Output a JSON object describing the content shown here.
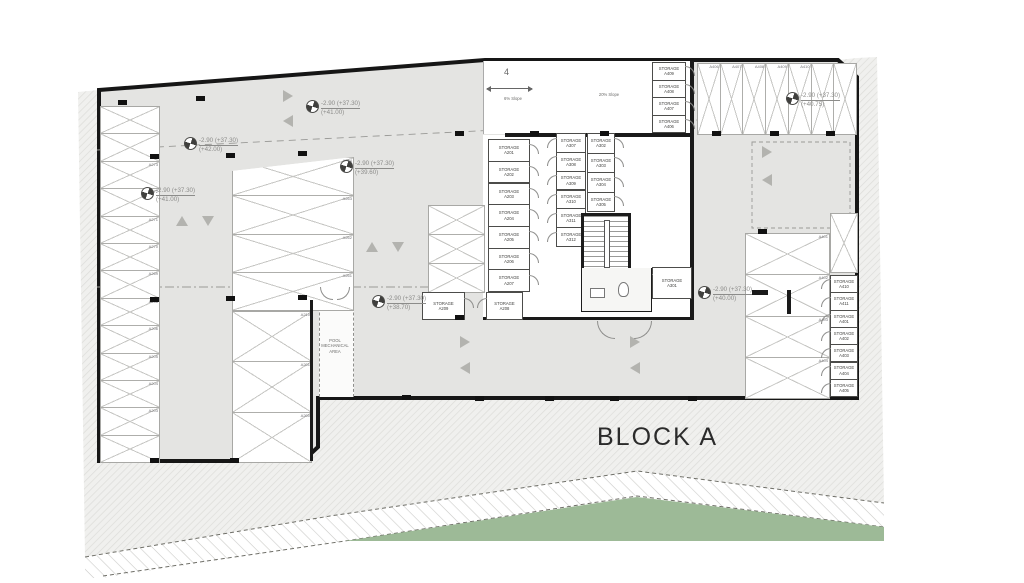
{
  "title": {
    "block_label": "BLOCK A"
  },
  "ramp": {
    "number": "4",
    "slope_left": "6% Slope",
    "slope_right": "20% Slope"
  },
  "pool_area_label": "POOL MECHANICAL AREA",
  "storage": {
    "prefix": "STORAGE",
    "col_left": [
      "A201",
      "A202",
      "A203",
      "A204",
      "A205",
      "A206",
      "A207"
    ],
    "col_mid": [
      "A307",
      "A308",
      "A309",
      "A310",
      "A311",
      "A312"
    ],
    "col_right": [
      "A302",
      "A303",
      "A304",
      "A305"
    ],
    "near_stair": "A301",
    "bottom_pair": [
      "A209",
      "A208"
    ],
    "ramp_col": [
      "A409",
      "A408",
      "A407",
      "A406"
    ],
    "right_col": [
      "A410",
      "A411",
      "A401",
      "A402",
      "A403",
      "A404",
      "A405"
    ]
  },
  "parking_labels": {
    "left_column": [
      "",
      "",
      "A273",
      "A272",
      "A271",
      "A270",
      "A269",
      "A268",
      "A206",
      "A205",
      "A204",
      "A203",
      ""
    ],
    "left_block": [
      "A264",
      "A263",
      "A262",
      "A261"
    ],
    "left_lower": [
      "A210",
      "A201",
      "A200"
    ],
    "top_right": [
      "A406",
      "A407",
      "A408",
      "A409",
      "A410",
      "",
      ""
    ],
    "right_block": [
      "A401",
      "A402",
      "A403",
      "A404"
    ]
  },
  "elevation_markers": [
    {
      "line1": "-2.90 (+37.30)",
      "line2": "(+41.00)"
    },
    {
      "line1": "-2.90 (+37.30)",
      "line2": "(+42.00)"
    },
    {
      "line1": "-2.90 (+37.30)",
      "line2": "(+39.60)"
    },
    {
      "line1": "-2.90 (+37.30)",
      "line2": "(+41.00)"
    },
    {
      "line1": "-2.90 (+37.30)",
      "line2": "(+38.70)"
    },
    {
      "line1": "-2.90 (+37.30)",
      "line2": "(+40.00)"
    },
    {
      "line1": "-2.90 (+37.30)",
      "line2": "(+40.75)"
    }
  ],
  "colors": {
    "floor": "#e4e4e2",
    "wall": "#1a1a1a",
    "green": "#9dba97",
    "arrow": "#b3b3af",
    "marker_text": "#8c8c8a"
  }
}
